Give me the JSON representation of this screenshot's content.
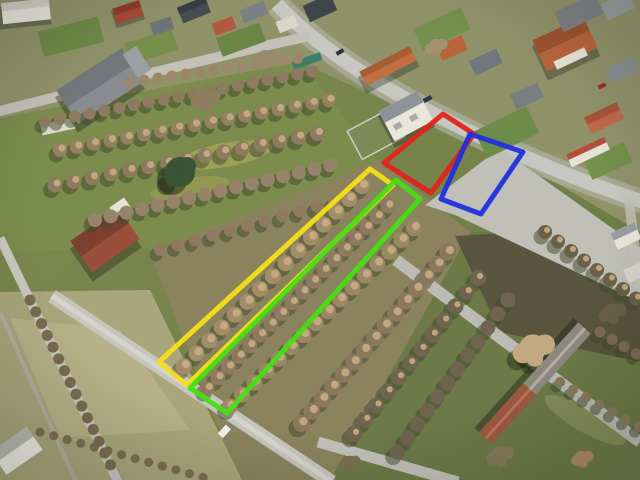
{
  "photo": {
    "kind": "aerial-drone-photo",
    "scene": "village street with houses, long garden plots with bare trees, lanes, and four land parcels marked with colored outlines"
  },
  "parcels": [
    {
      "id": "red",
      "color": "#e3231d",
      "points": "443,114 474,134 431,193 384,163"
    },
    {
      "id": "blue",
      "color": "#2030dd",
      "points": "470,134 523,152 481,214 441,199"
    },
    {
      "id": "yellow",
      "color": "#f4df18",
      "points": "370,169 393,185 187,385 159,362"
    },
    {
      "id": "green",
      "color": "#44df12",
      "points": "396,180 420,199 227,413 190,388"
    }
  ],
  "palette": {
    "parcel_red": "#e3231d",
    "parcel_blue": "#2030dd",
    "parcel_yellow": "#f4df18",
    "parcel_green": "#44df12",
    "grass_base": "#77854a",
    "dry_grass": "#a9a67c",
    "winter_trees": "#8d7a60",
    "tree_highlight": "#c8ad84",
    "road": "#c7c7c1",
    "roof_red": "#a84a36",
    "roof_orange": "#c2703f",
    "roof_gray": "#70767b",
    "wall_white": "#e9e7df"
  }
}
